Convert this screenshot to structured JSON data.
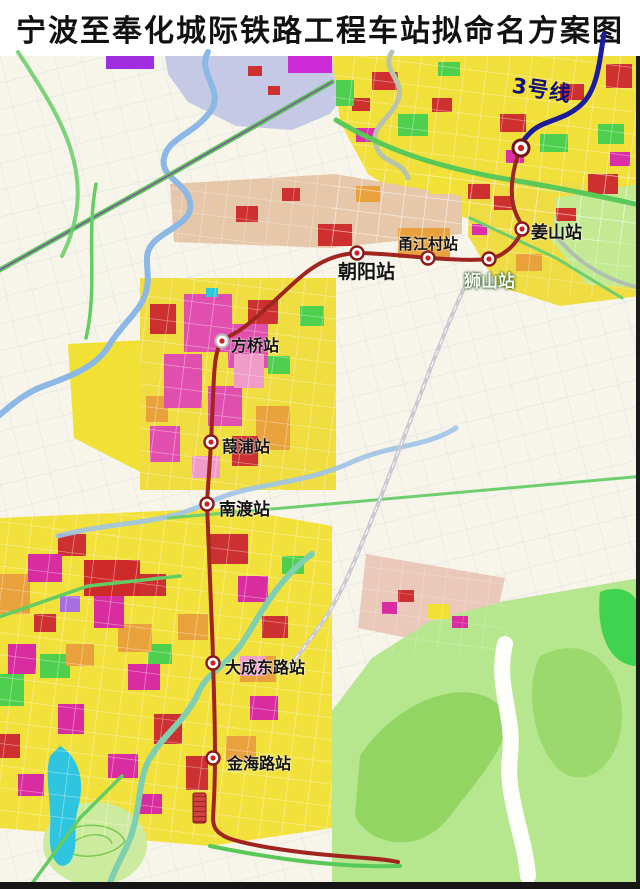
{
  "title": "宁波至奉化城际铁路工程车站拟命名方案图",
  "map": {
    "line_label": "3号线",
    "colors": {
      "intercity_line": "#a0251f",
      "line3": "#1c1c9e"
    },
    "stations": [
      {
        "name": "姜山站"
      },
      {
        "name": "狮山站"
      },
      {
        "name": "甬江村站"
      },
      {
        "name": "朝阳站"
      },
      {
        "name": "方桥站"
      },
      {
        "name": "葭浦站"
      },
      {
        "name": "南渡站"
      },
      {
        "name": "大成东路站"
      },
      {
        "name": "金海路站"
      }
    ]
  }
}
